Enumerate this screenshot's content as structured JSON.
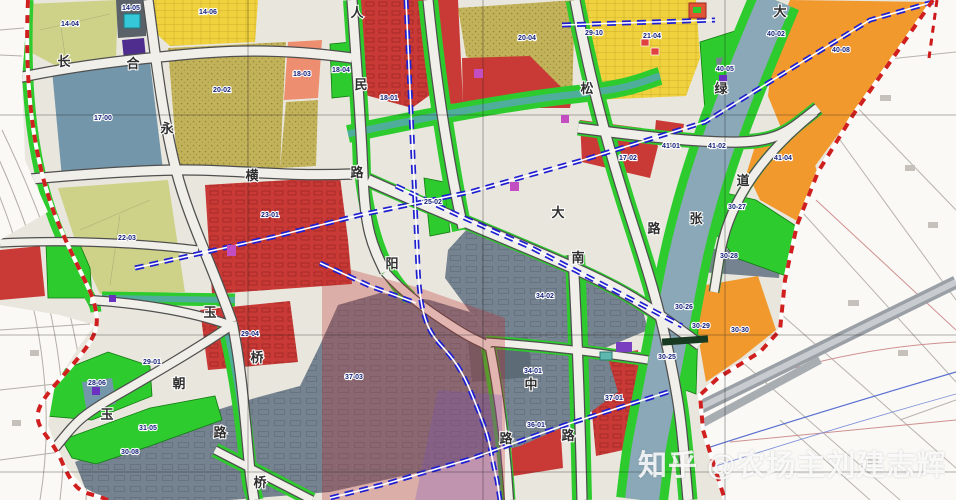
{
  "map": {
    "title": "控制性详细规划图 (urban zoning plan)",
    "watermark": "知乎 @农场主刘建志辉",
    "palette": {
      "residential_red": "#c93a36",
      "green_space": "#2ecb2e",
      "commercial_orange": "#f2992e",
      "mixed_yellow": "#efd23d",
      "village_khaki": "#c2b25a",
      "pale_residential": "#ced289",
      "salmon": "#ee8e70",
      "water_blue": "#8aa8b8",
      "facility_blue": "#7396aa",
      "industry_gray": "#75828f",
      "canal_teal": "#4fae9b",
      "metro_blue": "#1f1fd0",
      "boundary_red": "#d01f1f",
      "purple_utility": "#4f2d8f",
      "magenta_school": "#c24ec2"
    },
    "parcel_labels": [
      {
        "text": "14-04",
        "x": 70,
        "y": 26
      },
      {
        "text": "14-05",
        "x": 131,
        "y": 10
      },
      {
        "text": "14-06",
        "x": 208,
        "y": 14
      },
      {
        "text": "17-00",
        "x": 103,
        "y": 120
      },
      {
        "text": "20-02",
        "x": 222,
        "y": 92
      },
      {
        "text": "18-03",
        "x": 302,
        "y": 76
      },
      {
        "text": "18-04",
        "x": 341,
        "y": 72
      },
      {
        "text": "18-01",
        "x": 389,
        "y": 100
      },
      {
        "text": "22-03",
        "x": 127,
        "y": 240
      },
      {
        "text": "23-01",
        "x": 270,
        "y": 217
      },
      {
        "text": "29-04",
        "x": 250,
        "y": 336
      },
      {
        "text": "29-01",
        "x": 152,
        "y": 364
      },
      {
        "text": "28-06",
        "x": 97,
        "y": 385
      },
      {
        "text": "31-05",
        "x": 148,
        "y": 430
      },
      {
        "text": "30-08",
        "x": 130,
        "y": 454
      },
      {
        "text": "25-02",
        "x": 433,
        "y": 204
      },
      {
        "text": "20-04",
        "x": 527,
        "y": 40
      },
      {
        "text": "29-10",
        "x": 594,
        "y": 35
      },
      {
        "text": "21-04",
        "x": 652,
        "y": 38
      },
      {
        "text": "17-02",
        "x": 628,
        "y": 160
      },
      {
        "text": "40-02",
        "x": 776,
        "y": 36
      },
      {
        "text": "40-05",
        "x": 725,
        "y": 71
      },
      {
        "text": "40-08",
        "x": 841,
        "y": 52
      },
      {
        "text": "41-01",
        "x": 671,
        "y": 148
      },
      {
        "text": "41-02",
        "x": 717,
        "y": 148
      },
      {
        "text": "41-04",
        "x": 783,
        "y": 160
      },
      {
        "text": "30-27",
        "x": 737,
        "y": 209
      },
      {
        "text": "30-28",
        "x": 729,
        "y": 258
      },
      {
        "text": "30-26",
        "x": 684,
        "y": 309
      },
      {
        "text": "30-29",
        "x": 701,
        "y": 328
      },
      {
        "text": "30-30",
        "x": 740,
        "y": 332
      },
      {
        "text": "30-25",
        "x": 667,
        "y": 359
      },
      {
        "text": "34-02",
        "x": 545,
        "y": 298
      },
      {
        "text": "34-01",
        "x": 533,
        "y": 373
      },
      {
        "text": "37-03",
        "x": 354,
        "y": 379
      },
      {
        "text": "37-01",
        "x": 614,
        "y": 400
      },
      {
        "text": "36-01",
        "x": 536,
        "y": 427
      }
    ],
    "road_labels": [
      {
        "text": "长",
        "x": 64,
        "y": 66
      },
      {
        "text": "合",
        "x": 133,
        "y": 68
      },
      {
        "text": "永",
        "x": 167,
        "y": 133
      },
      {
        "text": "横",
        "x": 252,
        "y": 180
      },
      {
        "text": "人",
        "x": 357,
        "y": 17
      },
      {
        "text": "民",
        "x": 361,
        "y": 89
      },
      {
        "text": "路",
        "x": 357,
        "y": 177
      },
      {
        "text": "阳",
        "x": 392,
        "y": 268
      },
      {
        "text": "大",
        "x": 558,
        "y": 217
      },
      {
        "text": "南",
        "x": 578,
        "y": 262
      },
      {
        "text": "中",
        "x": 531,
        "y": 389
      },
      {
        "text": "路",
        "x": 506,
        "y": 443
      },
      {
        "text": "路",
        "x": 568,
        "y": 440
      },
      {
        "text": "松",
        "x": 587,
        "y": 93
      },
      {
        "text": "绿",
        "x": 721,
        "y": 93
      },
      {
        "text": "道",
        "x": 743,
        "y": 185
      },
      {
        "text": "张",
        "x": 696,
        "y": 223
      },
      {
        "text": "路",
        "x": 654,
        "y": 233
      },
      {
        "text": "玉",
        "x": 210,
        "y": 317
      },
      {
        "text": "桥",
        "x": 257,
        "y": 362
      },
      {
        "text": "路",
        "x": 220,
        "y": 437
      },
      {
        "text": "桥",
        "x": 260,
        "y": 487
      },
      {
        "text": "朝",
        "x": 179,
        "y": 388
      },
      {
        "text": "玉",
        "x": 107,
        "y": 419
      },
      {
        "text": "大",
        "x": 780,
        "y": 16
      }
    ]
  }
}
